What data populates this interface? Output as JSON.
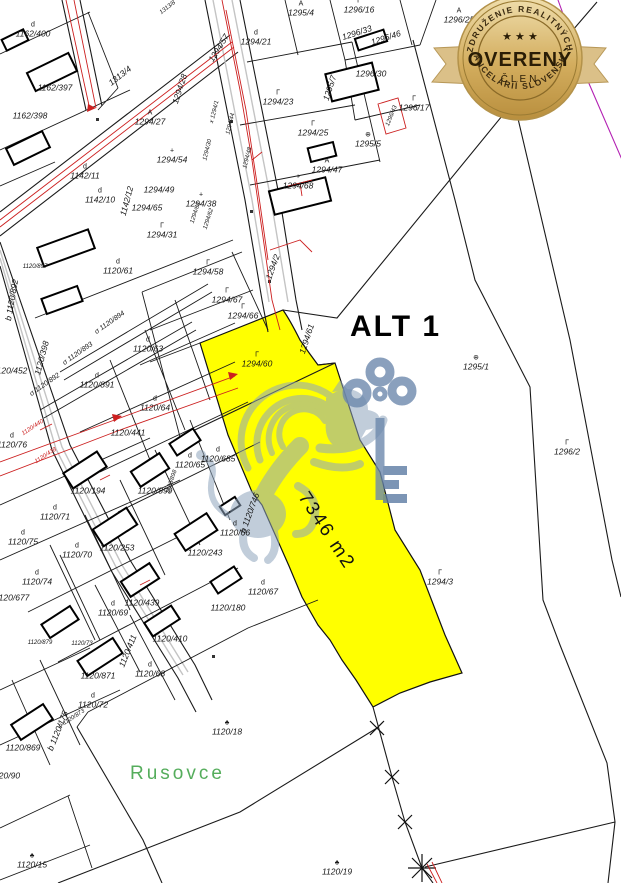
{
  "badge": {
    "top_arc": "ZDRUŽENIE REALITNÝCH",
    "bottom_arc": "KANCELÁRIÍ SLOVENSKA",
    "title": "OVERENÝ",
    "subtitle": "ČLEN",
    "stars": "★ ★ ★",
    "colors": {
      "gold": "#d3ad5e",
      "gold_light": "#f0dfae",
      "gold_dark": "#b98f3e",
      "ribbon": "#dbc088",
      "text": "#2a1d06"
    }
  },
  "map": {
    "alt_label": "ALT 1",
    "area_label": "7346 m2",
    "district_label": "Rusovce",
    "highlight_color": "#ffff00",
    "district_color": "#55ad5c",
    "line_color": "#1a1a1a",
    "red_color": "#cc2020",
    "magenta_color": "#b321b3",
    "sidewalk_color": "#c4c4c4",
    "watermark_lion_color": "#8fa5bd",
    "watermark_key_color": "#6d89ad",
    "parcels": [
      {
        "id": "1162/400",
        "x": 33,
        "y": 30,
        "sym": "d"
      },
      {
        "id": "1162/397",
        "x": 55,
        "y": 88
      },
      {
        "id": "1162/398",
        "x": 30,
        "y": 116
      },
      {
        "id": "1313/4",
        "x": 120,
        "y": 76,
        "rot": -38
      },
      {
        "id": "1313/8",
        "x": 168,
        "y": 8,
        "rot": -38,
        "fs": 6
      },
      {
        "id": "1294/27",
        "x": 150,
        "y": 118,
        "sym": "A"
      },
      {
        "id": "1294/28",
        "x": 180,
        "y": 89,
        "rot": -72
      },
      {
        "id": "1294/54",
        "x": 172,
        "y": 156,
        "sym": "+"
      },
      {
        "id": "1294/49",
        "x": 159,
        "y": 190
      },
      {
        "id": "1294/65",
        "x": 147,
        "y": 208
      },
      {
        "id": "1294/38",
        "x": 201,
        "y": 200,
        "sym": "+"
      },
      {
        "id": "1142/11",
        "x": 85,
        "y": 172,
        "sym": "d"
      },
      {
        "id": "1142/10",
        "x": 100,
        "y": 196,
        "sym": "d"
      },
      {
        "id": "1142/12",
        "x": 127,
        "y": 201,
        "rot": -75
      },
      {
        "id": "1294/31",
        "x": 162,
        "y": 231,
        "sym": "Γ"
      },
      {
        "id": "1294/57",
        "x": 219,
        "y": 48,
        "rot": -58
      },
      {
        "id": "1294/21",
        "x": 256,
        "y": 38,
        "sym": "d"
      },
      {
        "id": "1295/4",
        "x": 301,
        "y": 9,
        "sym": "A"
      },
      {
        "id": "1296/16",
        "x": 359,
        "y": 6,
        "sym": "Γ"
      },
      {
        "id": "1296/33",
        "x": 357,
        "y": 33,
        "rot": -18
      },
      {
        "id": "1296/46",
        "x": 386,
        "y": 38,
        "rot": -18
      },
      {
        "id": "1296/30",
        "x": 371,
        "y": 74
      },
      {
        "id": "1295/7",
        "x": 330,
        "y": 88,
        "rot": -72
      },
      {
        "id": "1296/17",
        "x": 414,
        "y": 104,
        "sym": "Γ"
      },
      {
        "id": "1296/43",
        "x": 392,
        "y": 116,
        "rot": -68,
        "fs": 6
      },
      {
        "id": "1295/5",
        "x": 368,
        "y": 140,
        "sym": "⊕"
      },
      {
        "id": "1294/23",
        "x": 278,
        "y": 98,
        "sym": "Γ"
      },
      {
        "id": "1294/25",
        "x": 313,
        "y": 129,
        "sym": "Γ"
      },
      {
        "id": "1294/47",
        "x": 327,
        "y": 166,
        "sym": "A"
      },
      {
        "id": "1294/68",
        "x": 298,
        "y": 182,
        "sym": "+"
      },
      {
        "id": "x 1294/1",
        "x": 215,
        "y": 112,
        "rot": -76,
        "fs": 6
      },
      {
        "id": "1294/44",
        "x": 231,
        "y": 124,
        "rot": -76,
        "fs": 6
      },
      {
        "id": "1294/30",
        "x": 208,
        "y": 150,
        "rot": -76,
        "fs": 6
      },
      {
        "id": "1294/48",
        "x": 248,
        "y": 158,
        "rot": -76,
        "fs": 6
      },
      {
        "id": "1294/63",
        "x": 196,
        "y": 213,
        "rot": -72,
        "fs": 6
      },
      {
        "id": "1294/62",
        "x": 209,
        "y": 219,
        "rot": -72,
        "fs": 6
      },
      {
        "id": "1294/58",
        "x": 208,
        "y": 268,
        "sym": "Γ"
      },
      {
        "id": "1294/67",
        "x": 227,
        "y": 296,
        "sym": "Γ"
      },
      {
        "id": "1294/66",
        "x": 243,
        "y": 312,
        "sym": "Γ"
      },
      {
        "id": "1294/2",
        "x": 273,
        "y": 267,
        "rot": -70
      },
      {
        "id": "1294/60",
        "x": 257,
        "y": 360,
        "sym": "Γ"
      },
      {
        "id": "1294/61",
        "x": 307,
        "y": 339,
        "rot": -72
      },
      {
        "id": "1295/1",
        "x": 476,
        "y": 363,
        "sym": "⊕"
      },
      {
        "id": "1296/2",
        "x": 567,
        "y": 448,
        "sym": "Γ"
      },
      {
        "id": "1294/3",
        "x": 440,
        "y": 578,
        "sym": "Γ"
      },
      {
        "id": "1296/25",
        "x": 459,
        "y": 16,
        "sym": "A"
      },
      {
        "id": "1398/27",
        "x": 520,
        "y": 3,
        "fs": 6
      },
      {
        "id": "b 1120/892",
        "x": 12,
        "y": 300,
        "rot": -80
      },
      {
        "id": "σ 1120/894",
        "x": 110,
        "y": 323,
        "rot": -35,
        "fs": 7
      },
      {
        "id": "σ 1120/893",
        "x": 78,
        "y": 354,
        "rot": -35,
        "fs": 7
      },
      {
        "id": "σ 1120/892",
        "x": 45,
        "y": 385,
        "rot": -35,
        "fs": 7
      },
      {
        "id": "1120/897",
        "x": 35,
        "y": 267,
        "fs": 6
      },
      {
        "id": "1120/61",
        "x": 118,
        "y": 267,
        "sym": "d"
      },
      {
        "id": "1120/63",
        "x": 148,
        "y": 345,
        "sym": "d"
      },
      {
        "id": "1120/891",
        "x": 97,
        "y": 381,
        "sym": "d"
      },
      {
        "id": "1120/64",
        "x": 155,
        "y": 404,
        "sym": "d"
      },
      {
        "id": "1120/441",
        "x": 128,
        "y": 433
      },
      {
        "id": "1120/452",
        "x": 10,
        "y": 371
      },
      {
        "id": "1120/398",
        "x": 42,
        "y": 358,
        "rot": -75
      },
      {
        "id": "1120/76",
        "x": 12,
        "y": 441,
        "sym": "d"
      },
      {
        "id": "1120/440",
        "x": 33,
        "y": 428,
        "rot": -33,
        "c": "#cc2020",
        "fs": 6
      },
      {
        "id": "1120/438",
        "x": 46,
        "y": 456,
        "rot": -33,
        "c": "#cc2020",
        "fs": 6
      },
      {
        "id": "1120/65",
        "x": 190,
        "y": 461,
        "sym": "d"
      },
      {
        "id": "1120/194",
        "x": 88,
        "y": 491
      },
      {
        "id": "1120/899",
        "x": 155,
        "y": 491
      },
      {
        "id": "1120/898",
        "x": 172,
        "y": 482,
        "rot": -72,
        "fs": 6
      },
      {
        "id": "1120/71",
        "x": 55,
        "y": 513,
        "sym": "d"
      },
      {
        "id": "1120/75",
        "x": 23,
        "y": 538,
        "sym": "d"
      },
      {
        "id": "1120/70",
        "x": 77,
        "y": 551,
        "sym": "d"
      },
      {
        "id": "1120/253",
        "x": 117,
        "y": 548
      },
      {
        "id": "1120/74",
        "x": 37,
        "y": 578,
        "sym": "d"
      },
      {
        "id": "1120/677",
        "x": 12,
        "y": 598
      },
      {
        "id": "1120/69",
        "x": 113,
        "y": 609,
        "sym": "d"
      },
      {
        "id": "1120/439",
        "x": 142,
        "y": 603
      },
      {
        "id": "1120/410",
        "x": 170,
        "y": 639
      },
      {
        "id": "1120/411",
        "x": 128,
        "y": 651,
        "rot": -68
      },
      {
        "id": "1120/66",
        "x": 235,
        "y": 529,
        "sym": "d"
      },
      {
        "id": "1120/243",
        "x": 205,
        "y": 553
      },
      {
        "id": "1120/67",
        "x": 263,
        "y": 588,
        "sym": "d"
      },
      {
        "id": "1120/180",
        "x": 228,
        "y": 608
      },
      {
        "id": "1120/68",
        "x": 150,
        "y": 670,
        "sym": "d"
      },
      {
        "id": "1120/685",
        "x": 218,
        "y": 455,
        "sym": "d"
      },
      {
        "id": "b 1120/746",
        "x": 250,
        "y": 513,
        "rot": -70
      },
      {
        "id": "1120/879",
        "x": 40,
        "y": 643,
        "fs": 6
      },
      {
        "id": "1120/73",
        "x": 82,
        "y": 644,
        "fs": 6
      },
      {
        "id": "1120/871",
        "x": 98,
        "y": 676
      },
      {
        "id": "1120/72",
        "x": 93,
        "y": 701,
        "sym": "d"
      },
      {
        "id": "b 1120/873",
        "x": 72,
        "y": 719,
        "rot": -33,
        "fs": 6
      },
      {
        "id": "b 1120/175",
        "x": 58,
        "y": 731,
        "rot": -68
      },
      {
        "id": "1120/869",
        "x": 23,
        "y": 748
      },
      {
        "id": "1120/90",
        "x": 5,
        "y": 776
      },
      {
        "id": "1120/18",
        "x": 227,
        "y": 728,
        "sym": "♣"
      },
      {
        "id": "1120/15",
        "x": 32,
        "y": 861,
        "sym": "♣"
      },
      {
        "id": "1120/19",
        "x": 337,
        "y": 868,
        "sym": "♣"
      }
    ]
  }
}
